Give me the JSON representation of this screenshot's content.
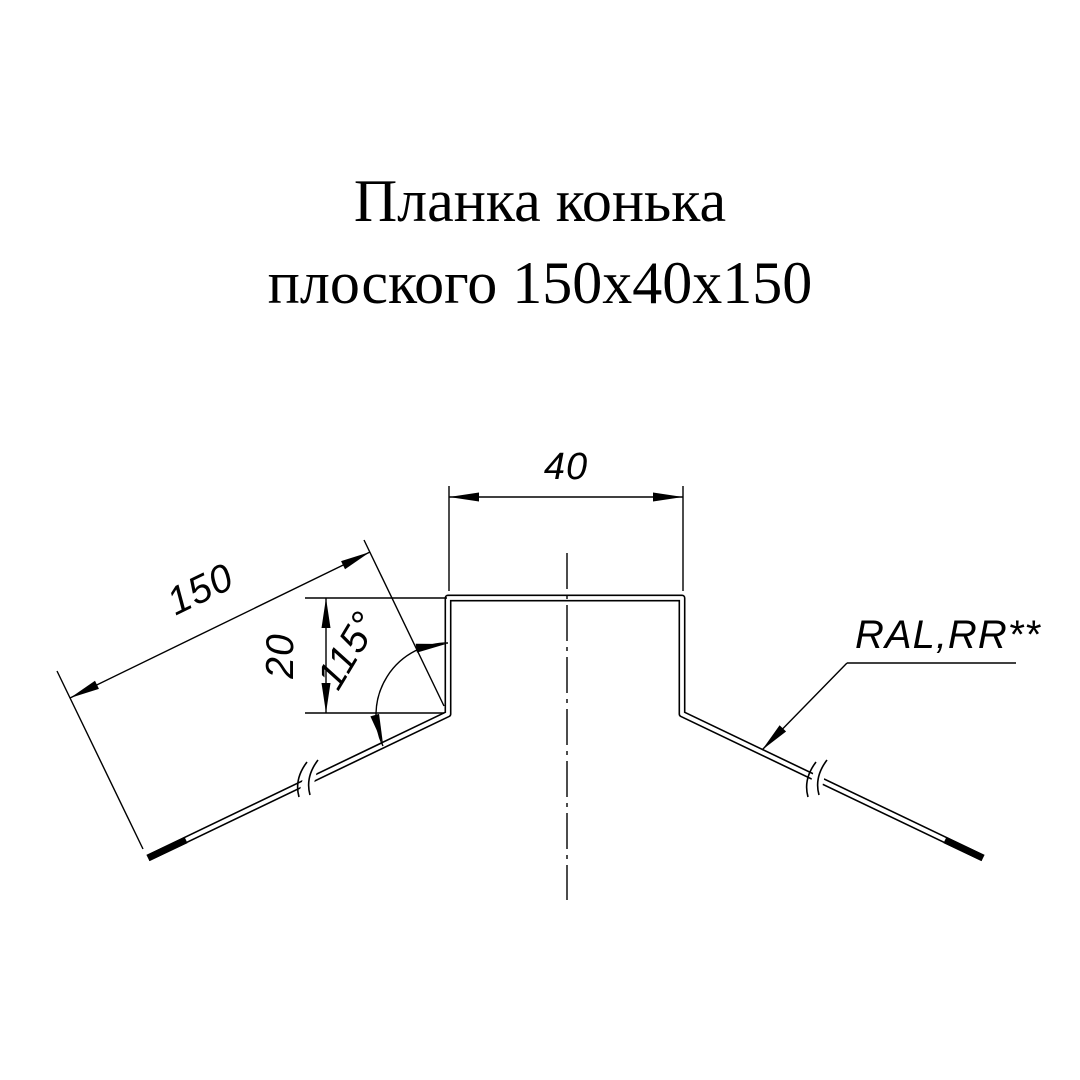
{
  "title": {
    "line1": "Планка конька",
    "line2": "плоского 150х40х150"
  },
  "drawing": {
    "dim_top_width": "40",
    "dim_side_length": "150",
    "dim_vertical_height": "20",
    "dim_bend_angle": "115°",
    "coating_label": "RAL,RR**"
  },
  "colors": {
    "ink": "#000000",
    "background": "#ffffff"
  }
}
